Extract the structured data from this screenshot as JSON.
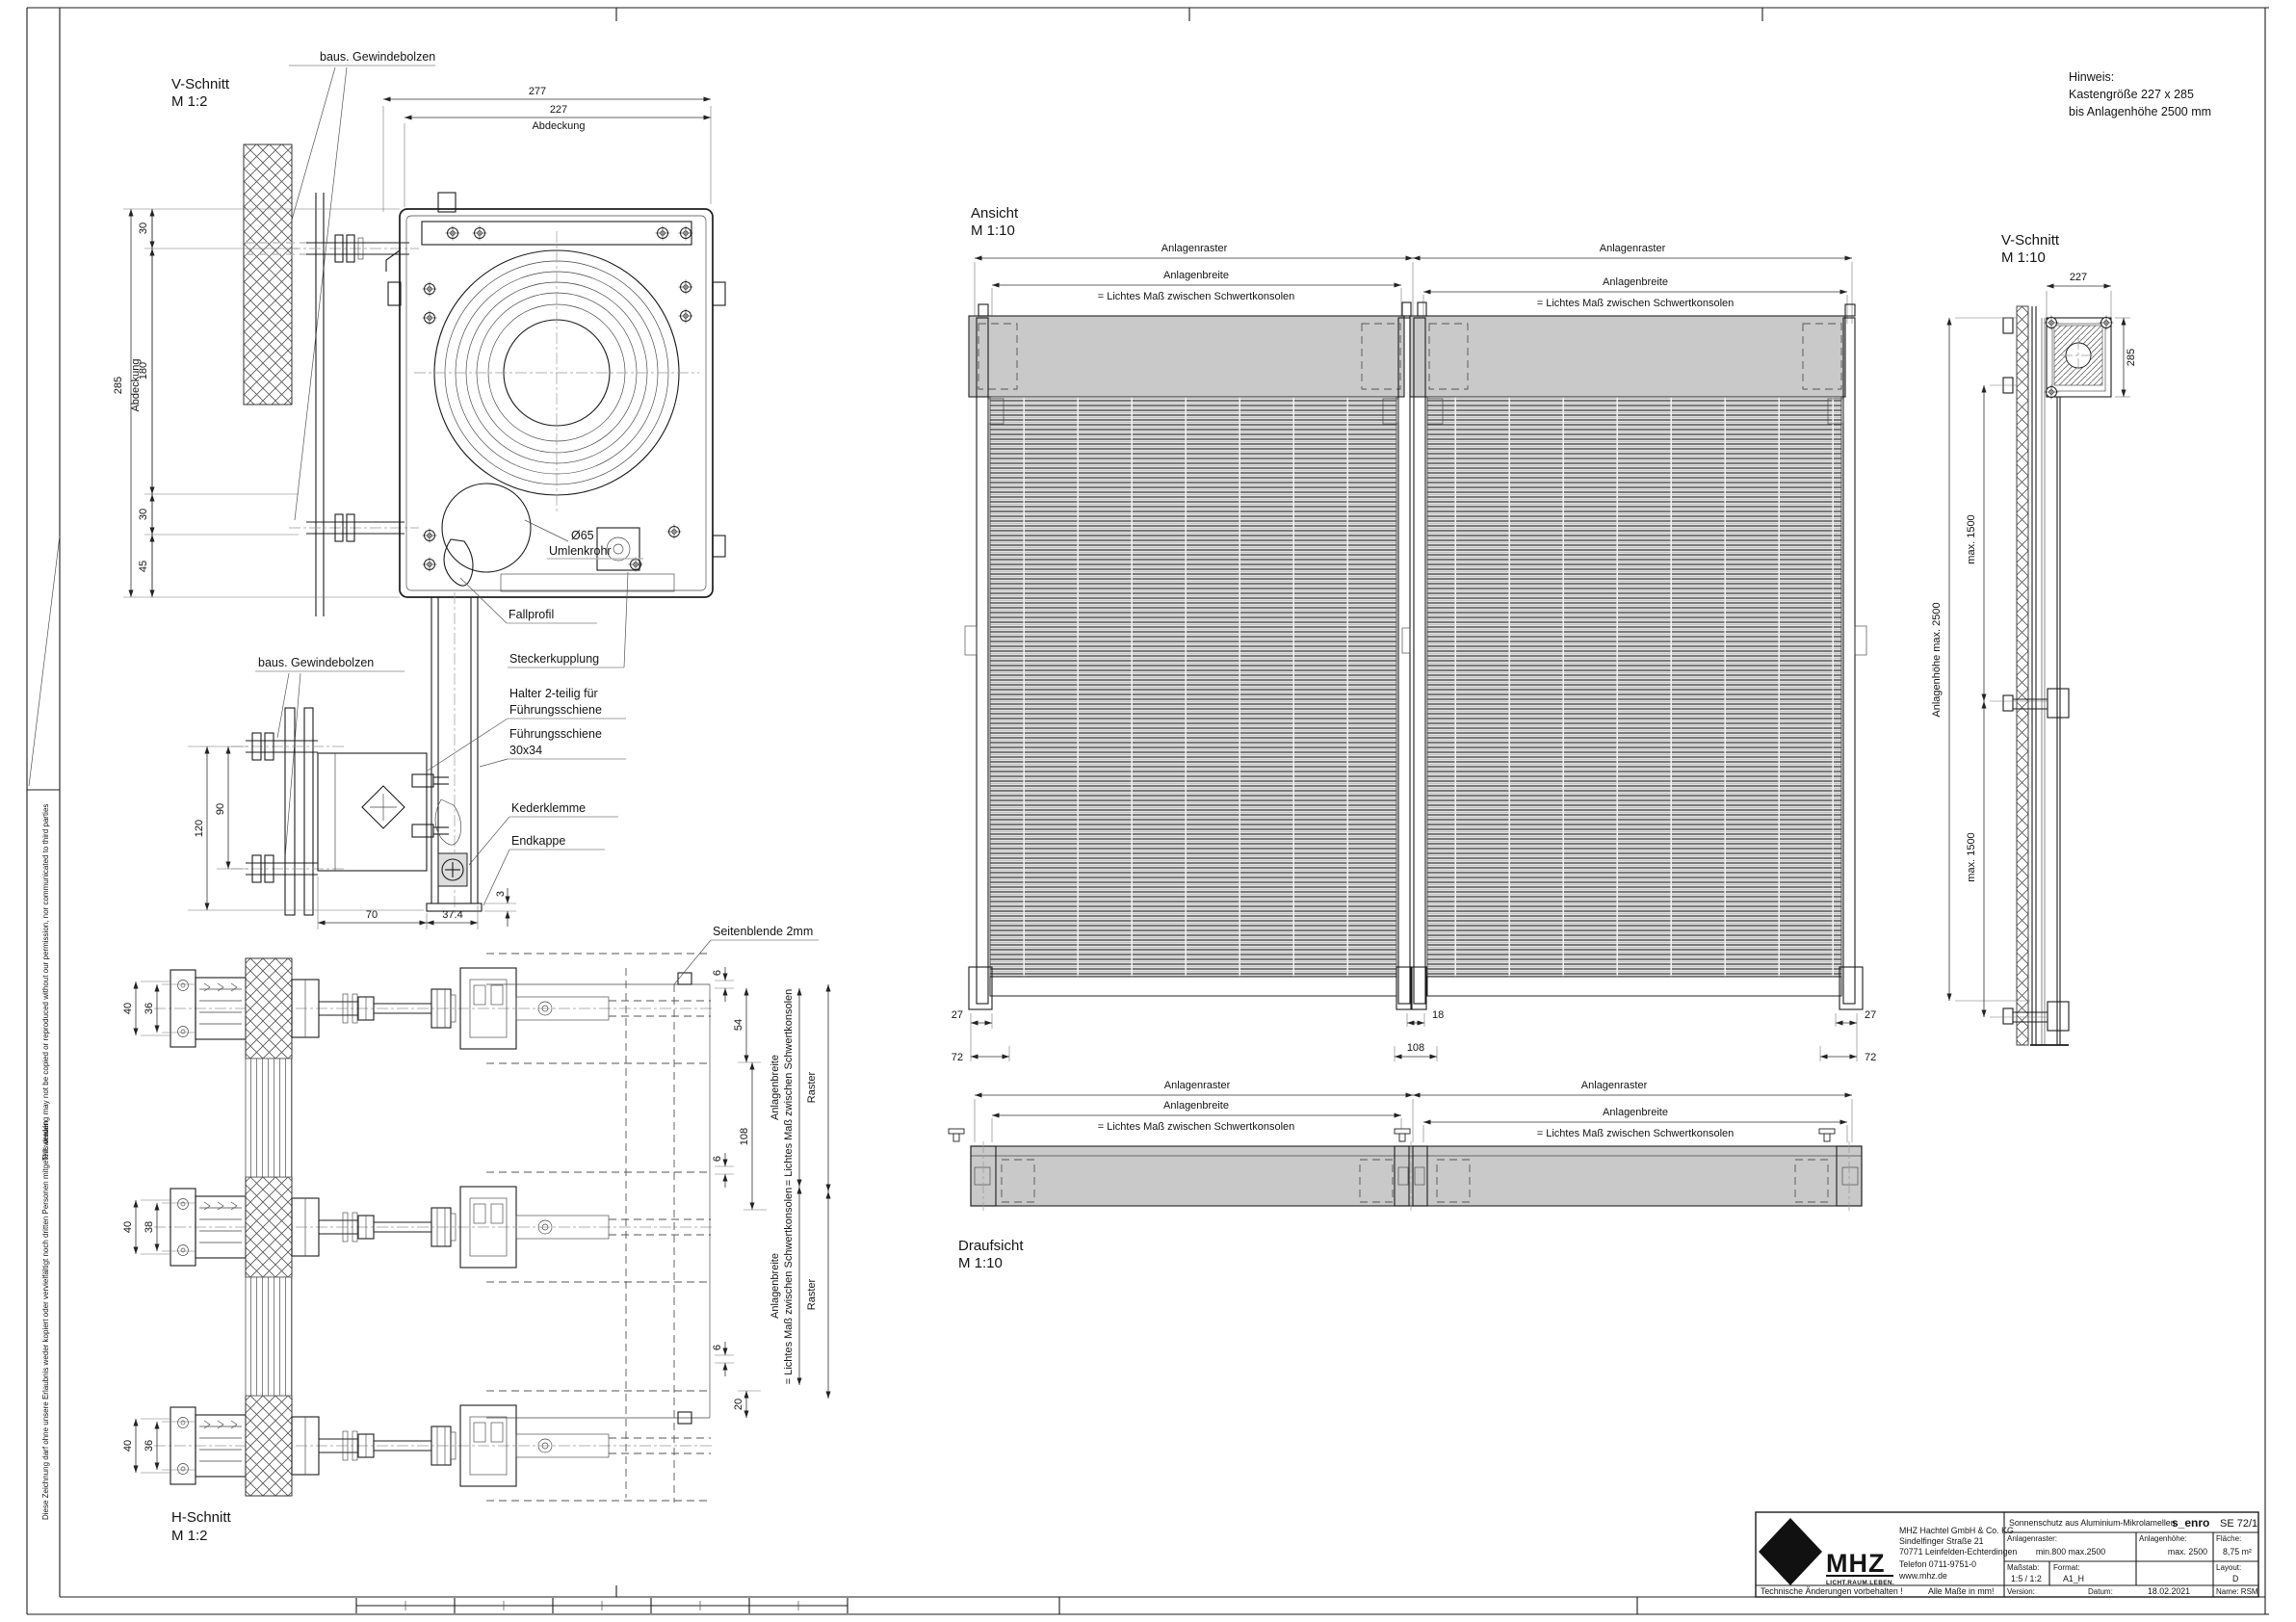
{
  "sheet": {
    "fold_note_de": "Diese Zeichnung darf ohne unsere Erlaubnis weder kopiert oder  vervielfältigt noch dritten Personen mitgeteilt werden",
    "fold_note_en": "This drawing may not be copied or reproduced without our permission, nor communicated to third parties"
  },
  "hinweis": {
    "line1": "Hinweis:",
    "line2": "Kastengröße  227 x 285",
    "line3": "bis  Anlagenhöhe  2500 mm"
  },
  "shared": {
    "anlagenraster": "Anlagenraster",
    "anlagenbreite": "Anlagenbreite",
    "lichtes_mass": "= Lichtes Maß zwischen Schwertkonsolen",
    "raster": "Raster",
    "gewindebolzen": "baus. Gewindebolzen"
  },
  "v_schnitt_m12": {
    "title": "V-Schnitt",
    "scale": "M 1:2",
    "dim_277": "277",
    "dim_227": "227",
    "abdeckung": "Abdeckung",
    "dim_285": "285",
    "dim_30_top": "30",
    "dim_180": "180",
    "dim_30_bottom": "30",
    "dim_45": "45",
    "label_o65": "Ø65",
    "label_umlenkrohr": "Umlenkrohr",
    "label_fallprofil": "Fallprofil",
    "label_steckerkupplung": "Steckerkupplung"
  },
  "fuehrung_detail": {
    "label_halter_1": "Halter 2-teilig für",
    "label_halter_2": "Führungsschiene",
    "label_schiene_1": "Führungsschiene",
    "label_schiene_2": "30x34",
    "label_kederklemme": "Kederklemme",
    "label_endkappe": "Endkappe",
    "dim_120": "120",
    "dim_90": "90",
    "dim_70": "70",
    "dim_37_4": "37.4",
    "dim_3": "3"
  },
  "h_schnitt": {
    "title": "H-Schnitt",
    "scale": "M 1:2",
    "label_seitenblende": "Seitenblende 2mm",
    "dim_40": "40",
    "dim_36": "36",
    "dim_38": "38",
    "dim_6": "6",
    "dim_54": "54",
    "dim_108": "108",
    "dim_20": "20"
  },
  "ansicht": {
    "title": "Ansicht",
    "scale": "M 1:10",
    "dim_27": "27",
    "dim_72": "72",
    "dim_18": "18",
    "dim_108": "108"
  },
  "draufsicht": {
    "title": "Draufsicht",
    "scale": "M 1:10"
  },
  "v_schnitt_m110": {
    "title": "V-Schnitt",
    "scale": "M 1:10",
    "dim_227": "227",
    "dim_285": "285",
    "dim_anlagenhoehe": "Anlagenhöhe  max. 2500",
    "dim_max_1500": "max. 1500"
  },
  "titleblock": {
    "logo": {
      "brand": "MHZ",
      "tagline": "LICHT.RAUM.LEBEN."
    },
    "company": [
      "MHZ Hachtel GmbH & Co. KG",
      "Sindelfinger Straße 21",
      "70771 Leinfelden-Echterdingen",
      "Telefon 0711-9751-0",
      "www.mhz.de"
    ],
    "notice": "Technische Änderungen vorbehalten !",
    "units": "Alle Maße in mm!",
    "product": "Sonnenschutz aus Aluminium-Mikrolamellen",
    "product_code": "s_enro",
    "product_nr": "SE 72/1",
    "anlagenraster_label": "Anlagenraster:",
    "anlagenraster_value": "min.800  max.2500",
    "anlagenhoehe_label": "Anlagenhöhe:",
    "anlagenhoehe_value": "max. 2500",
    "flaeche_label": "Fläche:",
    "flaeche_value": "8,75 m²",
    "massstab_label": "Maßstab:",
    "massstab_value": "1:5 / 1:2",
    "format_label": "Format:",
    "format_value": "A1_H",
    "layout_label": "Layout:",
    "layout_value": "D",
    "version_label": "Version:",
    "datum_label": "Datum:",
    "datum_value": "18.02.2021",
    "name_value": "Name: RSM"
  }
}
